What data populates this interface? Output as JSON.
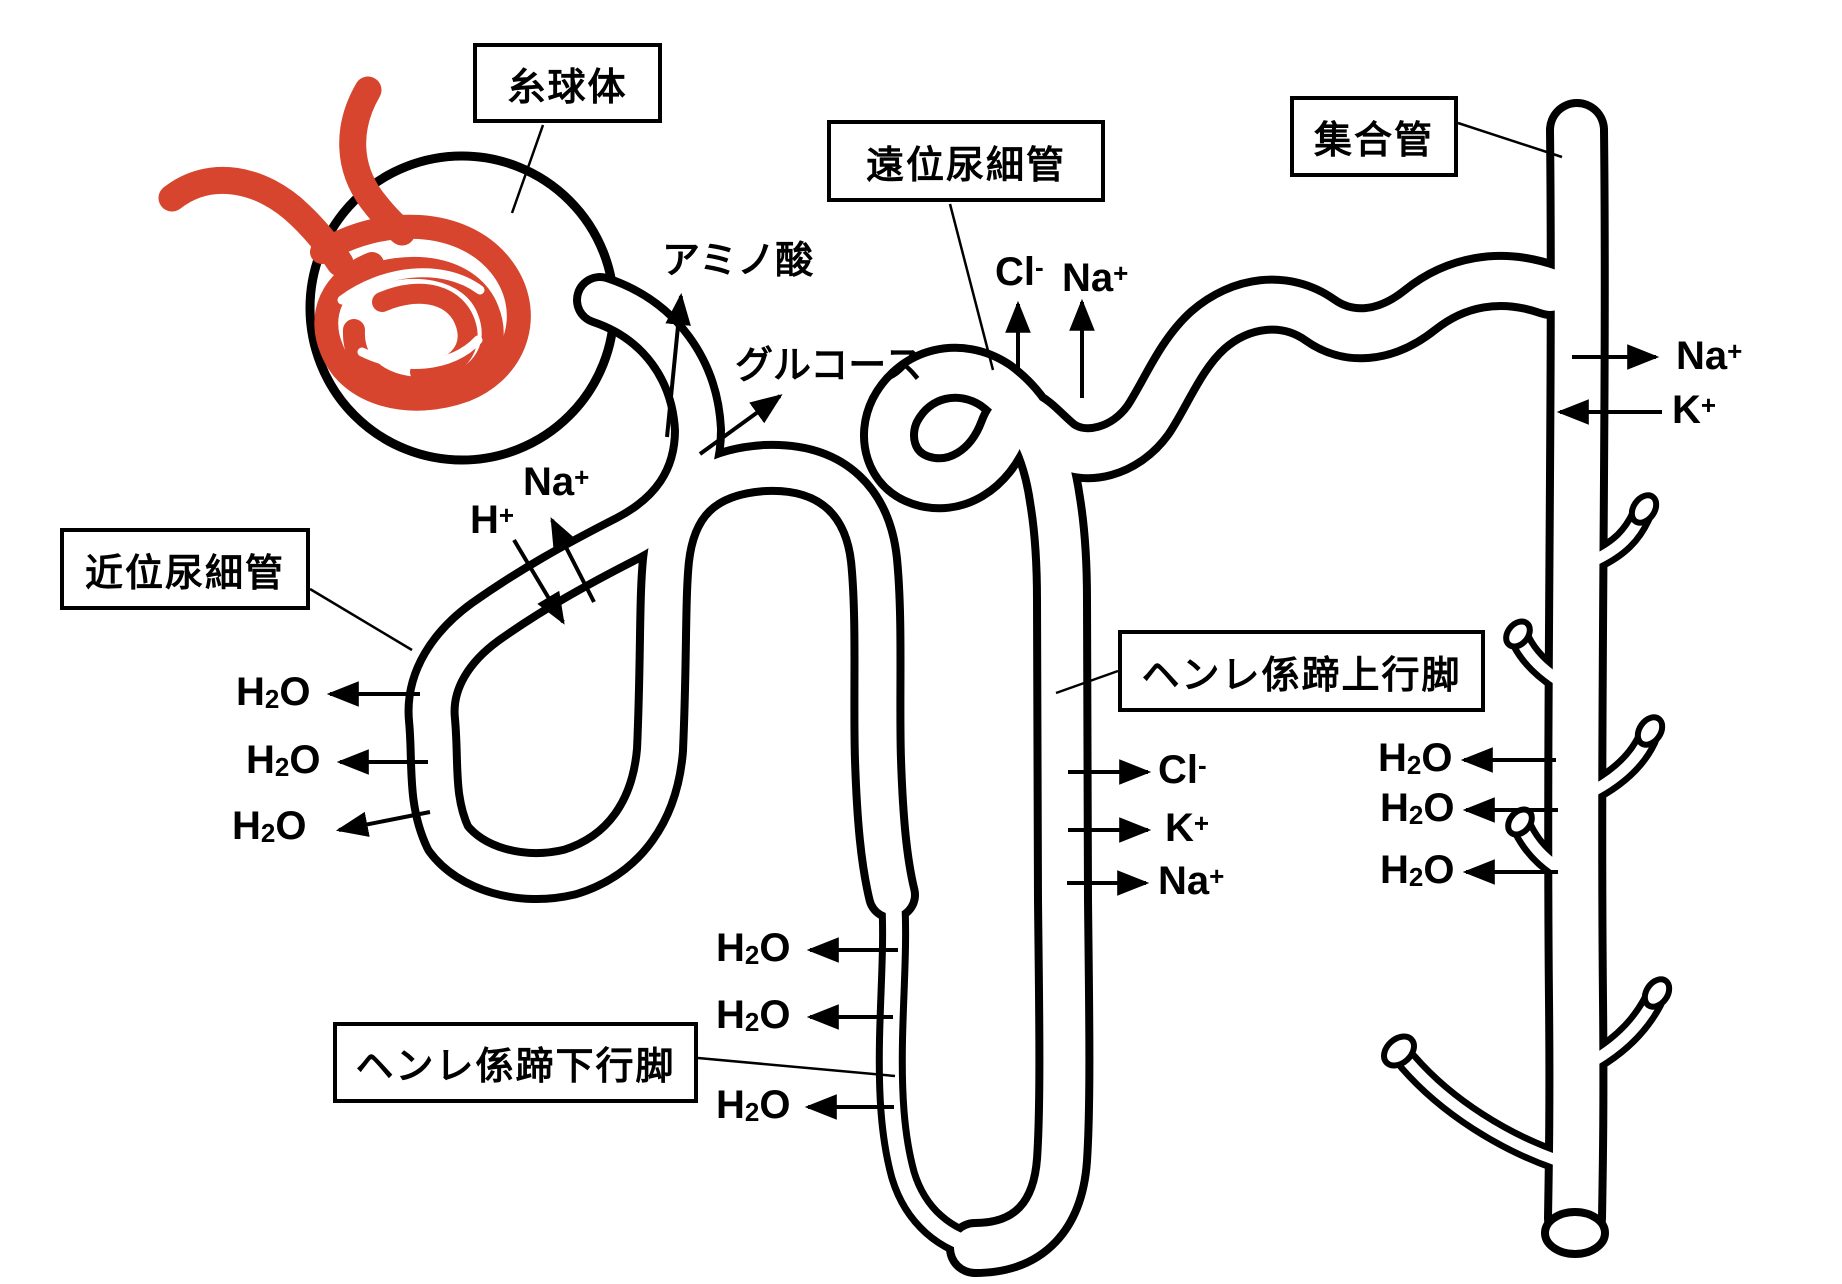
{
  "title": "ネフロン(腎単位)再吸収・分泌の模式図",
  "colors": {
    "background": "#ffffff",
    "glomerulus_red": "#d7452e",
    "line_black": "#000000"
  },
  "label_boxes": {
    "glomerulus": "糸球体",
    "proximal_tubule": "近位尿細管",
    "distal_tubule": "遠位尿細管",
    "collecting_duct": "集合管",
    "henle_ascending": "ヘンレ係蹄上行脚",
    "henle_descending": "ヘンレ係蹄下行脚"
  },
  "molecules": {
    "amino_acid": "アミノ酸",
    "glucose": "グルコース",
    "na_proximal": "Na+",
    "h_proximal": "H+",
    "cl_distal": "Cl-",
    "na_distal": "Na+",
    "h2o_left_1": "H2O",
    "h2o_left_2": "H2O",
    "h2o_left_3": "H2O",
    "h2o_bottom_1": "H2O",
    "h2o_bottom_2": "H2O",
    "h2o_bottom_3": "H2O",
    "cl_ascending": "Cl-",
    "k_ascending": "K+",
    "na_ascending": "Na+",
    "na_collecting": "Na+",
    "k_collecting": "K+",
    "h2o_right_1": "H2O",
    "h2o_right_2": "H2O",
    "h2o_right_3": "H2O"
  }
}
